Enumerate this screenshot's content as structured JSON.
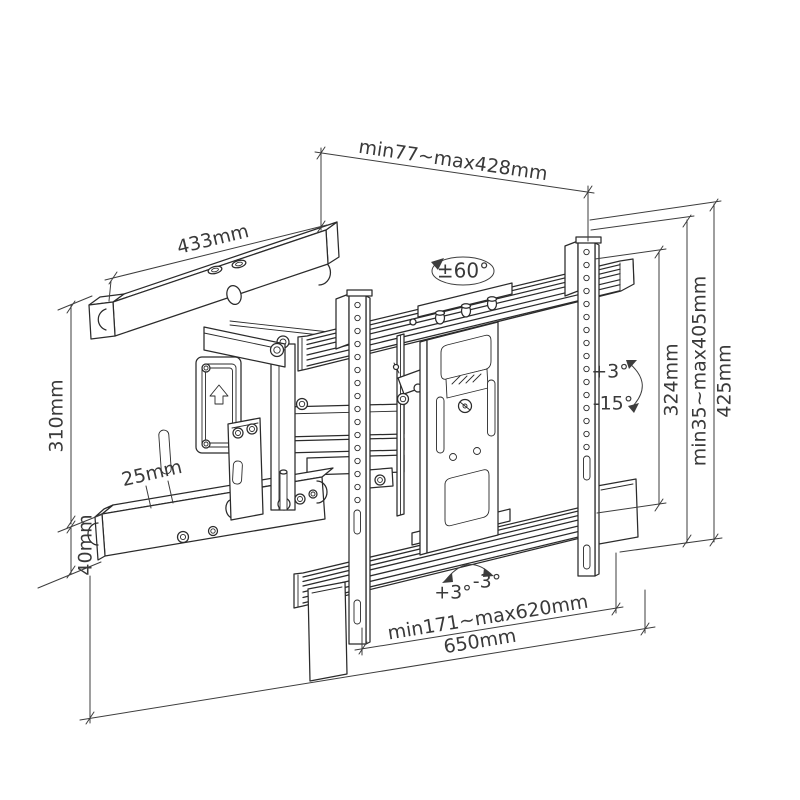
{
  "diagram": {
    "subject": "Full-motion TV wall mount bracket — dimensioned technical drawing",
    "labels": {
      "depth_range": "min77~max428mm",
      "upper_arm_length": "433mm",
      "swivel_range": "±60°",
      "wall_plate_height": "310mm",
      "arm_detail": "25mm",
      "lower_arm_height": "40mm",
      "inner_height": "324mm",
      "height_range": "min35~max405mm",
      "overall_height": "425mm",
      "tilt_up": "+3°",
      "tilt_down": "-15°",
      "level_left": "+3°",
      "level_right": "-3°",
      "width_range": "min171~max620mm",
      "overall_width": "650mm"
    },
    "line_color": "#2b2b2b",
    "text_color": "#3a3a3a",
    "background": "#ffffff"
  }
}
